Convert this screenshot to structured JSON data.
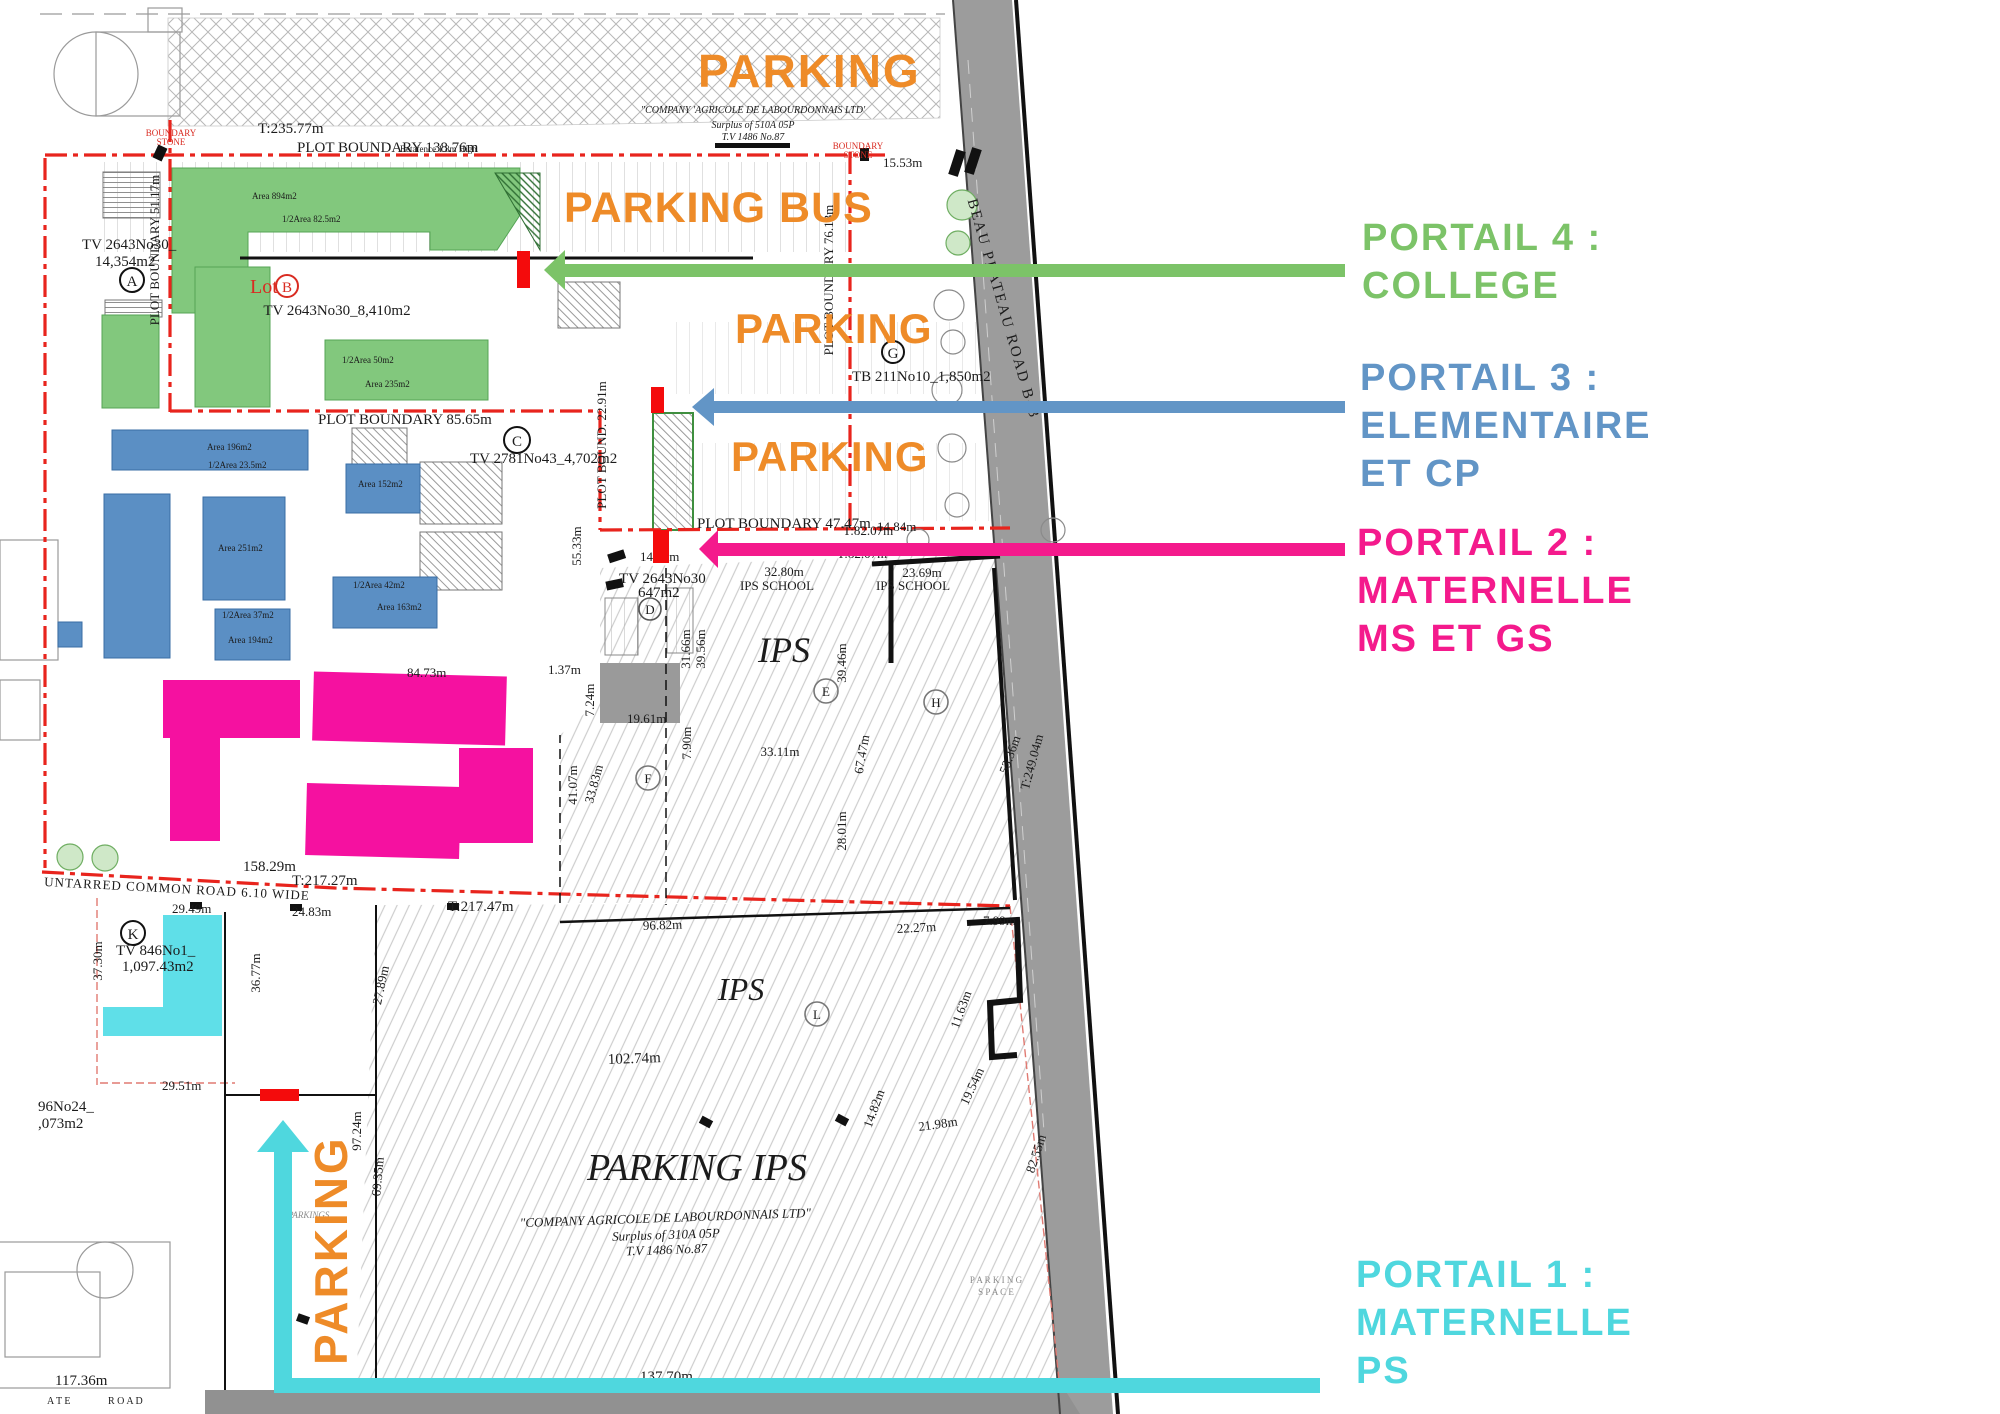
{
  "colors": {
    "orange": "#ee8b28",
    "portal4_green": "#7cc368",
    "portal3_blue": "#6295c6",
    "portal2_pink": "#f41a8c",
    "portal1_cyan": "#4fd7de",
    "building_green": "#82c87d",
    "building_blue": "#5b8fc4",
    "building_magenta": "#f511a0",
    "building_cyan": "#5fdfe8",
    "gate_red": "#f40b0c",
    "boundary_red": "#e8241d",
    "road_gray": "#9c9c9c"
  },
  "big_labels": {
    "parking_top": "PARKING",
    "parking_bus": "PARKING BUS",
    "parking_mid1": "PARKING",
    "parking_mid2": "PARKING",
    "parking_vertical": "PARKING"
  },
  "portals": [
    {
      "id": "portal-4",
      "lines": [
        "PORTAIL  4 :",
        "COLLEGE"
      ]
    },
    {
      "id": "portal-3",
      "lines": [
        "PORTAIL  3 :",
        "ELEMENTAIRE",
        "ET CP"
      ]
    },
    {
      "id": "portal-2",
      "lines": [
        "PORTAIL  2 :",
        "MATERNELLE",
        "MS ET GS"
      ]
    },
    {
      "id": "portal-1",
      "lines": [
        "PORTAIL  1 :",
        "MATERNELLE",
        "PS"
      ]
    }
  ],
  "plan": {
    "t235": "T:235.77m",
    "company_top1": "\"COMPANY 'AGRICOLE DE LABOURDONNAIS LTD'",
    "surplus_top": "Surplus of 510A 05P",
    "tv1486": "T.V 1486 No.87",
    "plot138": "PLOT BOUNDARY 138.76m",
    "betafence": "Betafence 1.8m High",
    "m1553": "15.53m",
    "bs1": "BOUNDARY",
    "bs2": "STONE",
    "tv2643_a1": "TV 2643No30_",
    "tv2643_a2": "14,354m2",
    "plot51": "PLOT BOUNDARY 51.17m",
    "area894": "Area 894m2",
    "half825": "1/2Area 82.5m2",
    "lot": "Lot",
    "lotB": "B",
    "tv2643_b": "TV 2643No30_8,410m2",
    "half50": "1/2Area 50m2",
    "area235": "Area 235m2",
    "plot8565": "PLOT BOUNDARY 85.65m",
    "tv2781": "TV 2781No43_4,702m2",
    "plot7613": "PLOT BOUNDARY 76.13m",
    "tb211": "TB 211No10_1,850m2",
    "plot2291": "PLOT BOUND. 22.91m",
    "m5533": "55.33m",
    "plot4747": "PLOT BOUNDARY 47.47m",
    "t8207a": "T:82.07m",
    "t8207b": "T:82.07m",
    "m1484": "14.84m",
    "m1485": "14.85m",
    "m3280": "32.80m",
    "ips_school1": "IPS SCHOOL",
    "m2369": "23.69m",
    "ips_school2": "IPS SCHOOL",
    "tv2643_c1": "TV 2643No30",
    "tv2643_c2": "647m2",
    "m3166": "31.66m",
    "m3956": "39.56m",
    "m3946": "39.46m",
    "ips1": "IPS",
    "ips2": "IPS",
    "parking_ips": "PARKING IPS",
    "m3311": "33.11m",
    "m790": "7.90m",
    "m6747": "67.47m",
    "m1961": "19.61m",
    "m3383": "33.83m",
    "m4107": "41.07m",
    "m2801": "28.01m",
    "m5336": "53.36m",
    "t24904": "T:249.04m",
    "m8473": "84.73m",
    "m137": "1.37m",
    "m724": "7.24m",
    "m15829": "158.29m",
    "t21727": "T:217.27m",
    "t21747": "T:217.47m",
    "untarred": "UNTARRED COMMON ROAD 6.10 WIDE",
    "m2949": "29.49m",
    "m2483": "24.83m",
    "m2951": "29.51m",
    "tv846_1": "TV 846No1_",
    "tv846_2": "1,097.43m2",
    "m3730": "37.30m",
    "m3677": "36.77m",
    "m2789": "27.89m",
    "tv296_1": "96No24_",
    "tv296_2": ",073m2",
    "m9724": "97.24m",
    "m6935": "69.35m",
    "parkings": "PARKINGS",
    "m9682": "96.82m",
    "m2227": "22.27m",
    "m799": "7.99m",
    "m1163": "11.63m",
    "m10274": "102.74m",
    "m2198": "21.98m",
    "m1954": "19.54m",
    "m1482": "14.82m",
    "m8255": "82.55m",
    "company_bot1": "\"COMPANY  AGRICOLE DE LABOURDONNAIS LTD\"",
    "surplus_bot": "Surplus of 310A 05P",
    "tv1486b": "T.V 1486 No.87",
    "m13770": "137.70m",
    "m11736": "117.36m",
    "parking_space1": "P A R K I N G",
    "parking_space2": "S P A C E",
    "road_ate": "A T E",
    "road_word": "R O A D",
    "road_name": "BEAU PLATEAU ROAD B43",
    "cA": "A",
    "cB": "B",
    "cC": "C",
    "cD": "D",
    "cE": "E",
    "cF": "F",
    "cG": "G",
    "cH": "H",
    "cK": "K",
    "cL": "L"
  }
}
